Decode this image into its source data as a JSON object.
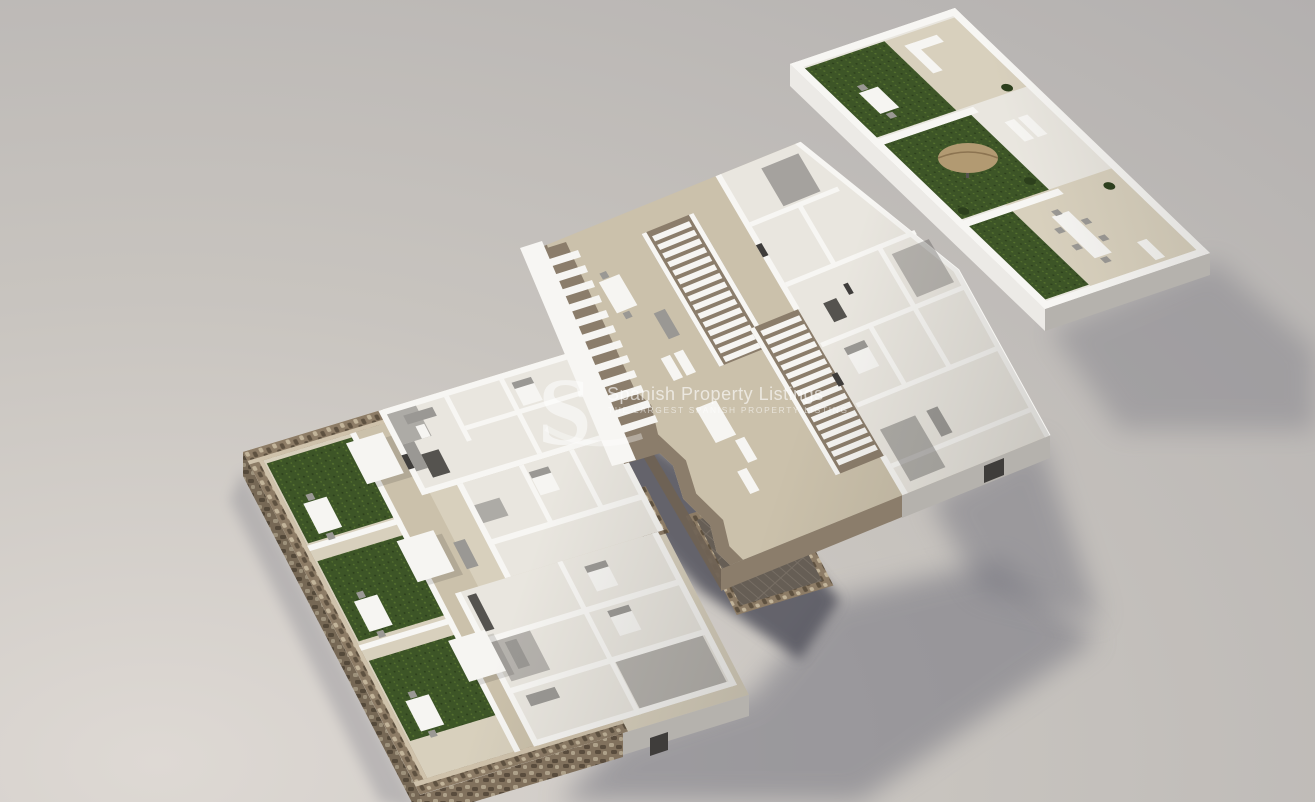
{
  "watermark": {
    "logo_letter": "S",
    "title": "Spanish Property Listings",
    "tagline": "THE LARGEST SPANISH PROPERTY LISTING"
  },
  "scene": {
    "description": "3D isometric cutaway floor-plan rendering of a three-level residential building, levels exploded and floating on a grey studio background with soft cast shadows",
    "levels": [
      {
        "id": "ground-floor",
        "label": "Ground floor plate with stone perimeter walls, three private artificial-grass gardens with white pergolas and dining sets, white-walled apartments and a rear dark timber deck patio",
        "position": "bottom-left"
      },
      {
        "id": "first-floor",
        "label": "First floor plate with two long white staircases, taupe fascia edges, tiled terraces with outdoor dining tables, loungers and white-walled bedrooms",
        "position": "center"
      },
      {
        "id": "roof-terrace",
        "label": "Roof solarium plate with white parapet walls, three bays of dark green turf and beige tiled decks, outdoor sofas, dining tables, loungers and a parasol",
        "position": "top-right"
      }
    ],
    "palette": {
      "bg-light": "#ded9d4",
      "bg-mid": "#c8c4bf",
      "bg-far": "#b3b0af",
      "shadow": "#73737e",
      "canyon": "#565660",
      "stone": "#8d7c66",
      "stone-dark": "#5e5140",
      "stone-light": "#c2b49a",
      "stone-top": "#cfc2ab",
      "grass": "#3d5527",
      "grass-dark": "#2c3f1c",
      "grass-light": "#56722f",
      "floor-beige": "#d8d0bd",
      "floor-terrace": "#cbc1ab",
      "floor-light": "#e9e6df",
      "wall-white": "#f7f6f3",
      "wall-lit": "#eceae6",
      "wall-shade": "#b5b2ad",
      "wall-dark": "#8c8984",
      "interior-dark": "#3f3d3b",
      "fascia": "#8b7d6b",
      "fascia-dark": "#6f6254",
      "deck": "#665e55",
      "deck-line": "#776e64",
      "furn-gray": "#9a9894",
      "furn-dark": "#55534f",
      "wood": "#b29a72"
    }
  }
}
